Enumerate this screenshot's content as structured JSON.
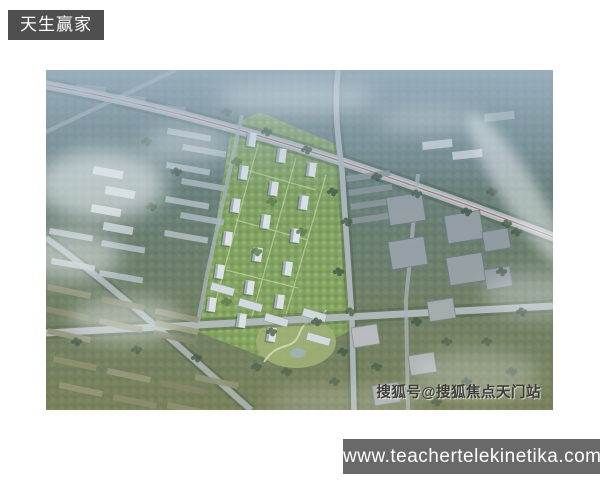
{
  "badge": {
    "label": "天生赢家"
  },
  "photo": {
    "watermark": "搜狐号@搜狐焦点天门站"
  },
  "footer": {
    "url": "www.teachertelekinetika.com"
  },
  "colors": {
    "badge_bg": "#4f4f4f",
    "footer_bg": "#696969",
    "haze_blue": "#7f9ab0",
    "tree_green": "#4c6149",
    "olive_green": "#8b8c6f",
    "compound_green": "#86a75c",
    "road_gray": "#b6bec1",
    "building_white": "#eaeff2"
  }
}
